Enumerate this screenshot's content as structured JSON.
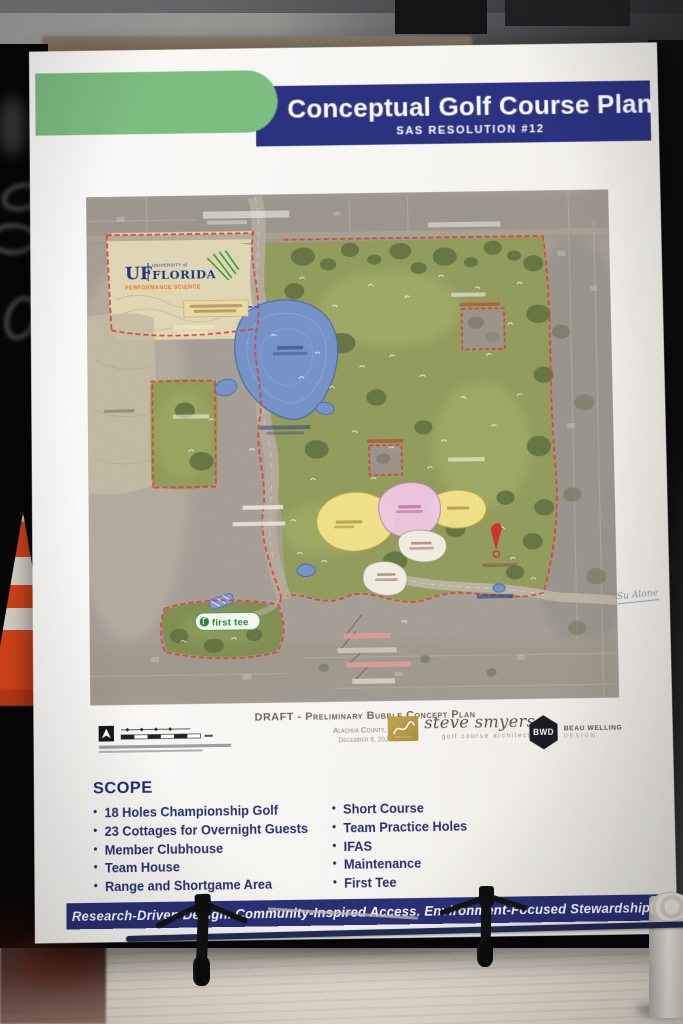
{
  "photo": {
    "handwritten_note": "Su Alone"
  },
  "poster": {
    "header": {
      "title": "Conceptual Golf Course Plan",
      "subtitle": "SAS RESOLUTION #12",
      "accent_green": "#7cbd80",
      "band_navy": "#2b3380"
    },
    "map": {
      "uf_logo": {
        "uf": "UF",
        "university": "UNIVERSITY of",
        "florida": "FLORIDA",
        "program": "PERFORMANCE SCIENCE"
      },
      "first_tee": "first tee"
    },
    "caption": {
      "line1": "DRAFT - Preliminary Bubble Concept Plan",
      "line2": "Alachua County, FL",
      "line3": "December 8, 2025"
    },
    "credits": {
      "smyers": {
        "name": "steve smyers",
        "tagline": "golf course architects"
      },
      "bwd": {
        "abbr": "BWD",
        "line1": "BEAU WELLING",
        "line2": "DESIGN"
      }
    },
    "scope": {
      "heading": "SCOPE",
      "left_items": [
        "18 Holes Championship Golf",
        "23 Cottages for Overnight Guests",
        "Member Clubhouse",
        "Team House",
        "Range and Shortgame Area"
      ],
      "right_items": [
        "Short Course",
        "Team Practice Holes",
        "IFAS",
        "Maintenance",
        "First Tee"
      ]
    },
    "footer": {
      "text": "Research-Driven Design. Community-Inspired Access. Environment-Focused Stewardship."
    },
    "colors": {
      "boundary_red": "#df4038",
      "course_green": "#93a058",
      "lake_blue": "#7693c8",
      "bubble_yellow": "#f3e38c",
      "bubble_pink": "#eec7e3",
      "marker_red": "#cf2f2a",
      "cone_orange": "#e64a1d"
    }
  }
}
